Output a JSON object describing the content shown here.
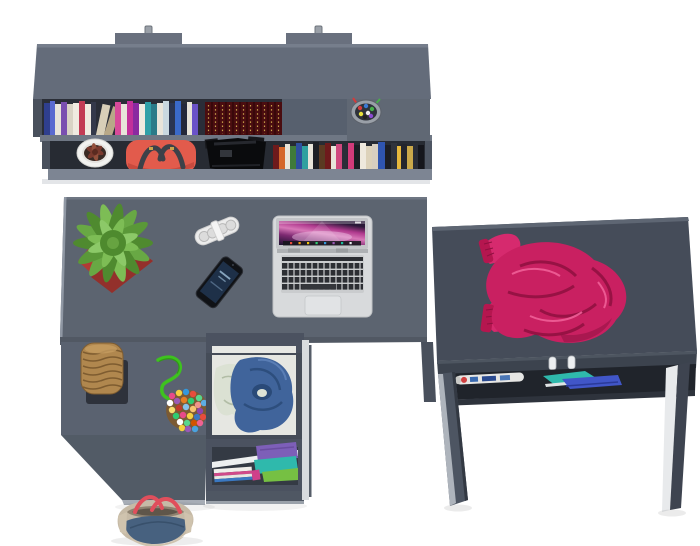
{
  "scene": {
    "title": "Top view 3D render of a graphite grey furniture set: wall shelf with books, corner desk with laptop, drawer unit and a small writing desk",
    "background": "#ffffff"
  },
  "palette": {
    "furniture_grey": "#5c6470",
    "furniture_grey_dark": "#454c59",
    "furniture_grey_darker": "#3c434e",
    "furniture_edge_light": "#7d8593",
    "panel_white": "#e8eaec",
    "pot_red": "#b23a34",
    "plant_green": "#68a844",
    "wicker_tan": "#b0874e",
    "rope_green": "#3ec21f",
    "jacket_blue": "#40649b",
    "sweater_magenta": "#c92061",
    "handbag_coral": "#e25b4c",
    "laptop_silver": "#d8dadc",
    "screen_pink": "#b03a8e",
    "tote_beige": "#c6baa6",
    "tote_denim": "#47617f",
    "strap_red": "#e04f5c"
  },
  "books": {
    "top_row_spines": [
      "#2f3f8e",
      "#5a6ad0",
      "#e8e4da",
      "#7a4fb0",
      "#d9d3c5",
      "#efeae0",
      "#c23b55",
      "#34394a",
      "#d8cfb8",
      "#b8a888",
      "#d84a9a",
      "#c2309a",
      "#8a2aa0",
      "#30a0a8",
      "#2a7a88",
      "#c9d8e0",
      "#2a3550",
      "#3a6ac8",
      "#24283a",
      "#6a52c8",
      "#2a2d38"
    ],
    "bottom_row_spines": [
      "#6e1a1c",
      "#d4662a",
      "#e8e4da",
      "#3f7a3a",
      "#2f4f9e",
      "#2fa0a0",
      "#1c1e24",
      "#5a3a22",
      "#d0487e",
      "#d23b7a",
      "#efe9dd",
      "#ddd2ba",
      "#2f55b0",
      "#30333c",
      "#e8b83c",
      "#caa84a",
      "#15161c"
    ],
    "antique_base": "#4a0d10",
    "antique_gold": "#c9a24a"
  },
  "pompom_colors": [
    "#e84a8a",
    "#f4d03f",
    "#3498db",
    "#e74c3c",
    "#58d68d",
    "#ffffff",
    "#9b59b6",
    "#e67e22",
    "#2ecc71",
    "#f1948a",
    "#5dade2",
    "#f7dc6f",
    "#c0392b",
    "#85c1e9",
    "#f8c471",
    "#8e44ad"
  ],
  "objects": {
    "wall_shelf": {
      "label": "grey wall shelf unit with two hanging brackets"
    },
    "books_top_row": {
      "label": "row of colourful books on the top shelf"
    },
    "antique_books": {
      "label": "dark red antique books with gold ornament"
    },
    "pencil_cup": {
      "label": "pencil cup with coloured pens"
    },
    "white_flower_pot": {
      "label": "white flower pot with small plant"
    },
    "red_handbag": {
      "label": "coral red handbag with dark straps"
    },
    "black_camera_bag": {
      "label": "black camera bag"
    },
    "books_bottom_row": {
      "label": "row of books on the lower shelf"
    },
    "main_desk": {
      "label": "grey corner desk with lower tier and front panel"
    },
    "potted_plant": {
      "label": "green succulent in red square pot"
    },
    "speaker": {
      "label": "white pill-shaped portable speaker"
    },
    "smartphone": {
      "label": "black smartphone"
    },
    "laptop": {
      "label": "open silver laptop with pink wallpaper"
    },
    "wicker_basket": {
      "label": "wicker basket on dark stand"
    },
    "green_cord": {
      "label": "green cord"
    },
    "pompom_pouch": {
      "label": "pouch covered in multicoloured pompoms"
    },
    "drawer_unit": {
      "label": "drawer unit with open drawer"
    },
    "open_drawer": {
      "label": "open drawer with blue jacket and light clothes"
    },
    "drawer_compartment": {
      "label": "lower compartment with folded clothes and magazines"
    },
    "floor_bag": {
      "label": "denim and beige tote bag with red straps"
    },
    "side_desk": {
      "label": "small grey writing desk with under-top shelf"
    },
    "pink_sweater": {
      "label": "crumpled raspberry knit sweater"
    },
    "side_desk_shelf": {
      "label": "under-desk shelf with rolled magazine and folded items"
    }
  }
}
